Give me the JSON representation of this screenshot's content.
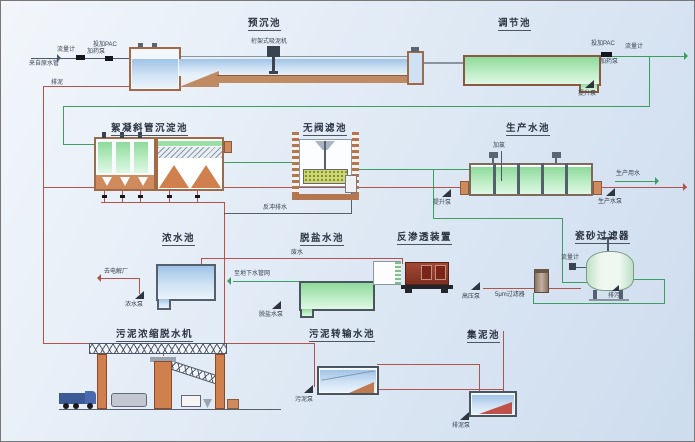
{
  "colors": {
    "background": "#dce8f4",
    "pipe_green": "#3d9e62",
    "pipe_red": "#b2544b",
    "wall_brown": "#a06a48",
    "water_blue": "#bdd6ef",
    "water_green": "#a8e3b0",
    "ro_red": "#8e3a28",
    "equipment_orange": "#d0804f"
  },
  "units": {
    "pre_sed": "预沉池",
    "regulating": "调节池",
    "flocculation": "絮凝斜管沉淀池",
    "valveless_filter": "无阀滤池",
    "production": "生产水池",
    "concentrate": "浓水池",
    "desalinated": "脱盐水池",
    "reverse_osmosis": "反渗透装置",
    "ceramic_filter": "瓷砂过滤器",
    "dewatering": "污泥浓缩脱水机",
    "sludge_transfer": "污泥转输水池",
    "sludge_collect": "集泥池"
  },
  "small": {
    "flow_meter": "流量计",
    "raw_inlet": "来自原水管",
    "dose_pac": "投加PAC",
    "dose_pump": "加药泵",
    "truss_machine": "桁架式吸泥机",
    "lift_pump": "提升泵",
    "drain_mud": "排泥",
    "backwash": "反冲排水",
    "chlorine": "加氯",
    "prod_pump": "生产水泵",
    "prod_water_out": "生产用水",
    "to_electrolysis": "去电解厂",
    "conc_pump": "浓水泵",
    "waste": "废水",
    "to_underground": "至地下水管网",
    "desal_pump": "脱盐水泵",
    "hp_pump": "高压泵",
    "cartridge": "5μm过滤器",
    "blowdown": "排污",
    "sludge_pump": "污泥泵",
    "mud_pump": "排泥泵"
  }
}
